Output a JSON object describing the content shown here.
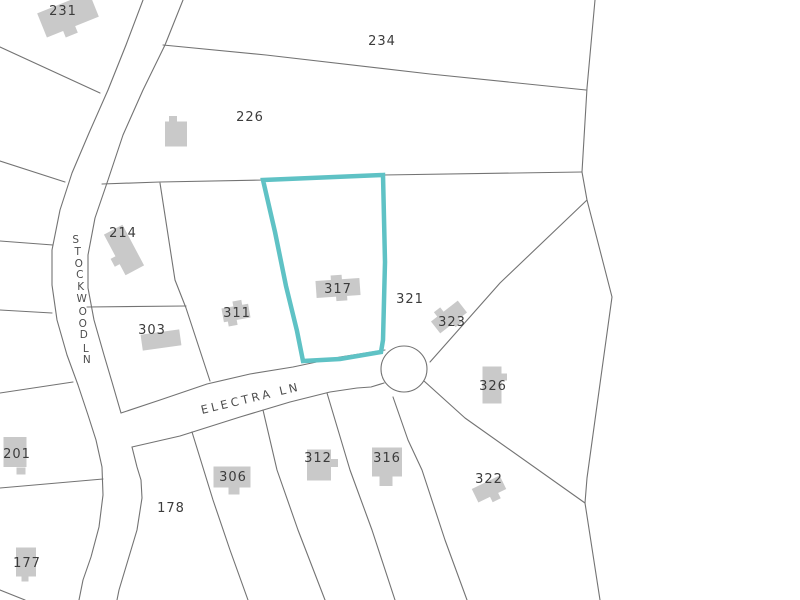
{
  "map": {
    "title": "Parcel map",
    "colors": {
      "background": "#ffffff",
      "boundary_line": "#737373",
      "road_line": "#737373",
      "building_fill": "#c9c9c9",
      "parcel_label": "#3c3c3c",
      "road_label": "#4d4d4d",
      "highlight": "#5fc2c5"
    },
    "highlight_stroke_width": 4.5,
    "line_width": 1.1,
    "selected_parcel": "317",
    "highlight_parcel": {
      "parcel": "317",
      "points": [
        [
          263,
          180
        ],
        [
          383,
          175
        ],
        [
          385,
          262
        ],
        [
          383,
          340
        ],
        [
          381,
          352
        ],
        [
          340,
          359
        ],
        [
          303,
          361
        ],
        [
          297,
          331
        ],
        [
          286,
          286
        ],
        [
          275,
          232
        ]
      ]
    },
    "parcels": [
      {
        "id": "231",
        "label": "231",
        "x": 63,
        "y": 15
      },
      {
        "id": "234",
        "label": "234",
        "x": 382,
        "y": 45
      },
      {
        "id": "226",
        "label": "226",
        "x": 250,
        "y": 121
      },
      {
        "id": "214",
        "label": "214",
        "x": 123,
        "y": 237
      },
      {
        "id": "303",
        "label": "303",
        "x": 152,
        "y": 334
      },
      {
        "id": "311",
        "label": "311",
        "x": 237,
        "y": 317
      },
      {
        "id": "317",
        "label": "317",
        "x": 338,
        "y": 293
      },
      {
        "id": "321",
        "label": "321",
        "x": 410,
        "y": 303
      },
      {
        "id": "323",
        "label": "323",
        "x": 452,
        "y": 326
      },
      {
        "id": "326",
        "label": "326",
        "x": 493,
        "y": 390
      },
      {
        "id": "322",
        "label": "322",
        "x": 489,
        "y": 483
      },
      {
        "id": "306",
        "label": "306",
        "x": 233,
        "y": 481
      },
      {
        "id": "312",
        "label": "312",
        "x": 318,
        "y": 462
      },
      {
        "id": "316",
        "label": "316",
        "x": 387,
        "y": 462
      },
      {
        "id": "178",
        "label": "178",
        "x": 171,
        "y": 512
      },
      {
        "id": "201",
        "label": "201",
        "x": 17,
        "y": 458
      },
      {
        "id": "177",
        "label": "177",
        "x": 27,
        "y": 567
      }
    ],
    "roads": [
      {
        "id": "stockwood-ln",
        "name": "STOCKWOOD LN",
        "letters": [
          {
            "ch": "S",
            "x": 76,
            "y": 243
          },
          {
            "ch": "T",
            "x": 78,
            "y": 255
          },
          {
            "ch": "O",
            "x": 79,
            "y": 267
          },
          {
            "ch": "C",
            "x": 80,
            "y": 278
          },
          {
            "ch": "K",
            "x": 81,
            "y": 290
          },
          {
            "ch": "W",
            "x": 82,
            "y": 302
          },
          {
            "ch": "O",
            "x": 83,
            "y": 315
          },
          {
            "ch": "O",
            "x": 83,
            "y": 327
          },
          {
            "ch": "D",
            "x": 84,
            "y": 338
          },
          {
            "ch": "L",
            "x": 86,
            "y": 352
          },
          {
            "ch": "N",
            "x": 87,
            "y": 363
          }
        ]
      },
      {
        "id": "electra-ln",
        "name": "ELECTRA LN",
        "label_x": 202,
        "label_y": 414,
        "label_angle": -13.5
      }
    ],
    "road_edges": [
      {
        "name": "road-edge-stockwood-west",
        "points": [
          [
            143,
            0
          ],
          [
            126,
            45
          ],
          [
            108,
            90
          ],
          [
            89,
            133
          ],
          [
            72,
            173
          ],
          [
            60,
            210
          ],
          [
            52,
            250
          ],
          [
            52,
            285
          ],
          [
            57,
            320
          ],
          [
            67,
            355
          ],
          [
            78,
            385
          ],
          [
            88,
            415
          ],
          [
            96,
            440
          ],
          [
            102,
            467
          ],
          [
            103,
            495
          ],
          [
            99,
            527
          ],
          [
            91,
            557
          ],
          [
            83,
            580
          ],
          [
            79,
            600
          ]
        ]
      },
      {
        "name": "road-edge-stockwood-east-upper",
        "points": [
          [
            183,
            0
          ],
          [
            165,
            45
          ],
          [
            143,
            90
          ],
          [
            123,
            135
          ],
          [
            108,
            180
          ],
          [
            95,
            218
          ],
          [
            88,
            255
          ],
          [
            88,
            288
          ],
          [
            94,
            320
          ],
          [
            104,
            355
          ],
          [
            112,
            382
          ],
          [
            121,
            413
          ]
        ]
      },
      {
        "name": "road-edge-stockwood-east-lower",
        "points": [
          [
            132,
            447
          ],
          [
            137,
            467
          ],
          [
            141,
            480
          ],
          [
            142,
            498
          ],
          [
            137,
            530
          ],
          [
            128,
            560
          ],
          [
            119,
            590
          ],
          [
            117,
            600
          ]
        ]
      },
      {
        "name": "road-edge-electra-north",
        "points": [
          [
            121,
            413
          ],
          [
            160,
            400
          ],
          [
            207,
            384
          ],
          [
            250,
            374
          ],
          [
            293,
            367
          ],
          [
            340,
            357
          ],
          [
            385,
            350
          ]
        ]
      },
      {
        "name": "road-edge-electra-south",
        "points": [
          [
            132,
            447
          ],
          [
            180,
            436
          ],
          [
            240,
            417
          ],
          [
            290,
            402
          ],
          [
            330,
            392
          ],
          [
            357,
            388
          ],
          [
            371,
            387
          ],
          [
            384,
            383
          ]
        ]
      }
    ],
    "culdesac": {
      "cx": 404,
      "cy": 369,
      "r": 23
    },
    "parcel_lines": [
      {
        "name": "boundary-231-south",
        "points": [
          [
            0,
            47
          ],
          [
            100,
            93
          ]
        ]
      },
      {
        "name": "boundary-west-1",
        "points": [
          [
            0,
            161
          ],
          [
            65,
            182
          ]
        ]
      },
      {
        "name": "boundary-west-2",
        "points": [
          [
            0,
            241
          ],
          [
            53,
            245
          ]
        ]
      },
      {
        "name": "boundary-west-3",
        "points": [
          [
            0,
            310
          ],
          [
            52,
            313
          ]
        ]
      },
      {
        "name": "boundary-201-north",
        "points": [
          [
            0,
            393
          ],
          [
            73,
            382
          ]
        ]
      },
      {
        "name": "boundary-177-north",
        "points": [
          [
            0,
            488
          ],
          [
            103,
            479
          ]
        ]
      },
      {
        "name": "boundary-corner-sw",
        "points": [
          [
            0,
            590
          ],
          [
            25,
            600
          ]
        ]
      },
      {
        "name": "boundary-234-south",
        "points": [
          [
            163,
            45
          ],
          [
            266,
            55
          ],
          [
            430,
            74
          ],
          [
            586,
            90
          ]
        ]
      },
      {
        "name": "boundary-226-south",
        "points": [
          [
            102,
            184
          ],
          [
            160,
            182
          ],
          [
            263,
            180
          ],
          [
            383,
            175
          ],
          [
            582,
            172
          ]
        ]
      },
      {
        "name": "boundary-east",
        "points": [
          [
            595,
            0
          ],
          [
            587,
            88
          ],
          [
            582,
            172
          ],
          [
            587,
            200
          ],
          [
            603,
            262
          ],
          [
            612,
            297
          ],
          [
            595,
            420
          ],
          [
            587,
            478
          ],
          [
            585,
            503
          ],
          [
            600,
            600
          ]
        ]
      },
      {
        "name": "boundary-321-323",
        "points": [
          [
            587,
            200
          ],
          [
            500,
            283
          ],
          [
            430,
            362
          ]
        ]
      },
      {
        "name": "boundary-326-322",
        "points": [
          [
            424,
            381
          ],
          [
            465,
            418
          ],
          [
            585,
            503
          ]
        ]
      },
      {
        "name": "boundary-214-311",
        "points": [
          [
            160,
            183
          ],
          [
            175,
            280
          ],
          [
            186,
            308
          ],
          [
            210,
            381
          ]
        ]
      },
      {
        "name": "boundary-214-303",
        "points": [
          [
            87,
            307
          ],
          [
            186,
            306
          ]
        ]
      },
      {
        "name": "boundary-306-west",
        "points": [
          [
            192,
            432
          ],
          [
            213,
            500
          ],
          [
            230,
            550
          ],
          [
            248,
            600
          ]
        ]
      },
      {
        "name": "boundary-306-312",
        "points": [
          [
            263,
            410
          ],
          [
            277,
            470
          ],
          [
            298,
            530
          ],
          [
            325,
            600
          ]
        ]
      },
      {
        "name": "boundary-312-316",
        "points": [
          [
            327,
            393
          ],
          [
            350,
            470
          ],
          [
            372,
            530
          ],
          [
            395,
            600
          ]
        ]
      },
      {
        "name": "boundary-316-east",
        "points": [
          [
            393,
            397
          ],
          [
            408,
            440
          ],
          [
            422,
            470
          ],
          [
            445,
            540
          ],
          [
            467,
            600
          ]
        ]
      }
    ],
    "buildings": [
      {
        "id": "231",
        "cx": 68,
        "cy": 15,
        "w": 56,
        "h": 26,
        "angle": -22,
        "tabs": [
          {
            "dx": -4,
            "dy": 16,
            "w": 13,
            "h": 8
          }
        ]
      },
      {
        "id": "226",
        "cx": 176,
        "cy": 134,
        "w": 22,
        "h": 25,
        "angle": 0,
        "tabs": [
          {
            "dx": -3,
            "dy": -15,
            "w": 8,
            "h": 6
          }
        ]
      },
      {
        "id": "214",
        "cx": 124,
        "cy": 250,
        "w": 21,
        "h": 46,
        "angle": -28,
        "tabs": [
          {
            "dx": -12,
            "dy": 6,
            "w": 8,
            "h": 9
          }
        ]
      },
      {
        "id": "303",
        "cx": 161,
        "cy": 340,
        "w": 39,
        "h": 16,
        "angle": -8,
        "tabs": []
      },
      {
        "id": "311",
        "cx": 236,
        "cy": 313,
        "w": 27,
        "h": 14,
        "angle": -10,
        "tabs": [
          {
            "dx": 3,
            "dy": -9,
            "w": 9,
            "h": 6
          },
          {
            "dx": -5,
            "dy": 9,
            "w": 9,
            "h": 6
          }
        ]
      },
      {
        "id": "317",
        "cx": 338,
        "cy": 288,
        "w": 44,
        "h": 17,
        "angle": -4,
        "tabs": [
          {
            "dx": -1,
            "dy": -10,
            "w": 11,
            "h": 6
          },
          {
            "dx": 3,
            "dy": 10,
            "w": 11,
            "h": 6
          }
        ]
      },
      {
        "id": "323",
        "cx": 449,
        "cy": 317,
        "w": 34,
        "h": 15,
        "angle": -38,
        "tabs": [
          {
            "dx": -5,
            "dy": -10,
            "w": 8,
            "h": 6
          },
          {
            "dx": 3,
            "dy": 9,
            "w": 8,
            "h": 6
          }
        ]
      },
      {
        "id": "326",
        "cx": 492,
        "cy": 385,
        "w": 19,
        "h": 37,
        "angle": 0,
        "tabs": [
          {
            "dx": 12,
            "dy": -8,
            "w": 6,
            "h": 7
          }
        ]
      },
      {
        "id": "322",
        "cx": 489,
        "cy": 489,
        "w": 31,
        "h": 15,
        "angle": -26,
        "tabs": [
          {
            "dx": 2,
            "dy": 10,
            "w": 9,
            "h": 7
          }
        ]
      },
      {
        "id": "312",
        "cx": 319,
        "cy": 465,
        "w": 24,
        "h": 31,
        "angle": 0,
        "tabs": [
          {
            "dx": 15,
            "dy": -2,
            "w": 8,
            "h": 8
          }
        ]
      },
      {
        "id": "316",
        "cx": 387,
        "cy": 462,
        "w": 30,
        "h": 29,
        "angle": 0,
        "tabs": [
          {
            "dx": -1,
            "dy": 19,
            "w": 13,
            "h": 10
          }
        ]
      },
      {
        "id": "306",
        "cx": 232,
        "cy": 477,
        "w": 37,
        "h": 21,
        "angle": 0,
        "tabs": [
          {
            "dx": 2,
            "dy": 14,
            "w": 11,
            "h": 7
          }
        ]
      },
      {
        "id": "201",
        "cx": 15,
        "cy": 452,
        "w": 23,
        "h": 30,
        "angle": 0,
        "tabs": [
          {
            "dx": 6,
            "dy": 19,
            "w": 9,
            "h": 7
          }
        ]
      },
      {
        "id": "177",
        "cx": 26,
        "cy": 562,
        "w": 20,
        "h": 29,
        "angle": 0,
        "tabs": [
          {
            "dx": -1,
            "dy": 17,
            "w": 7,
            "h": 5
          }
        ]
      }
    ]
  }
}
